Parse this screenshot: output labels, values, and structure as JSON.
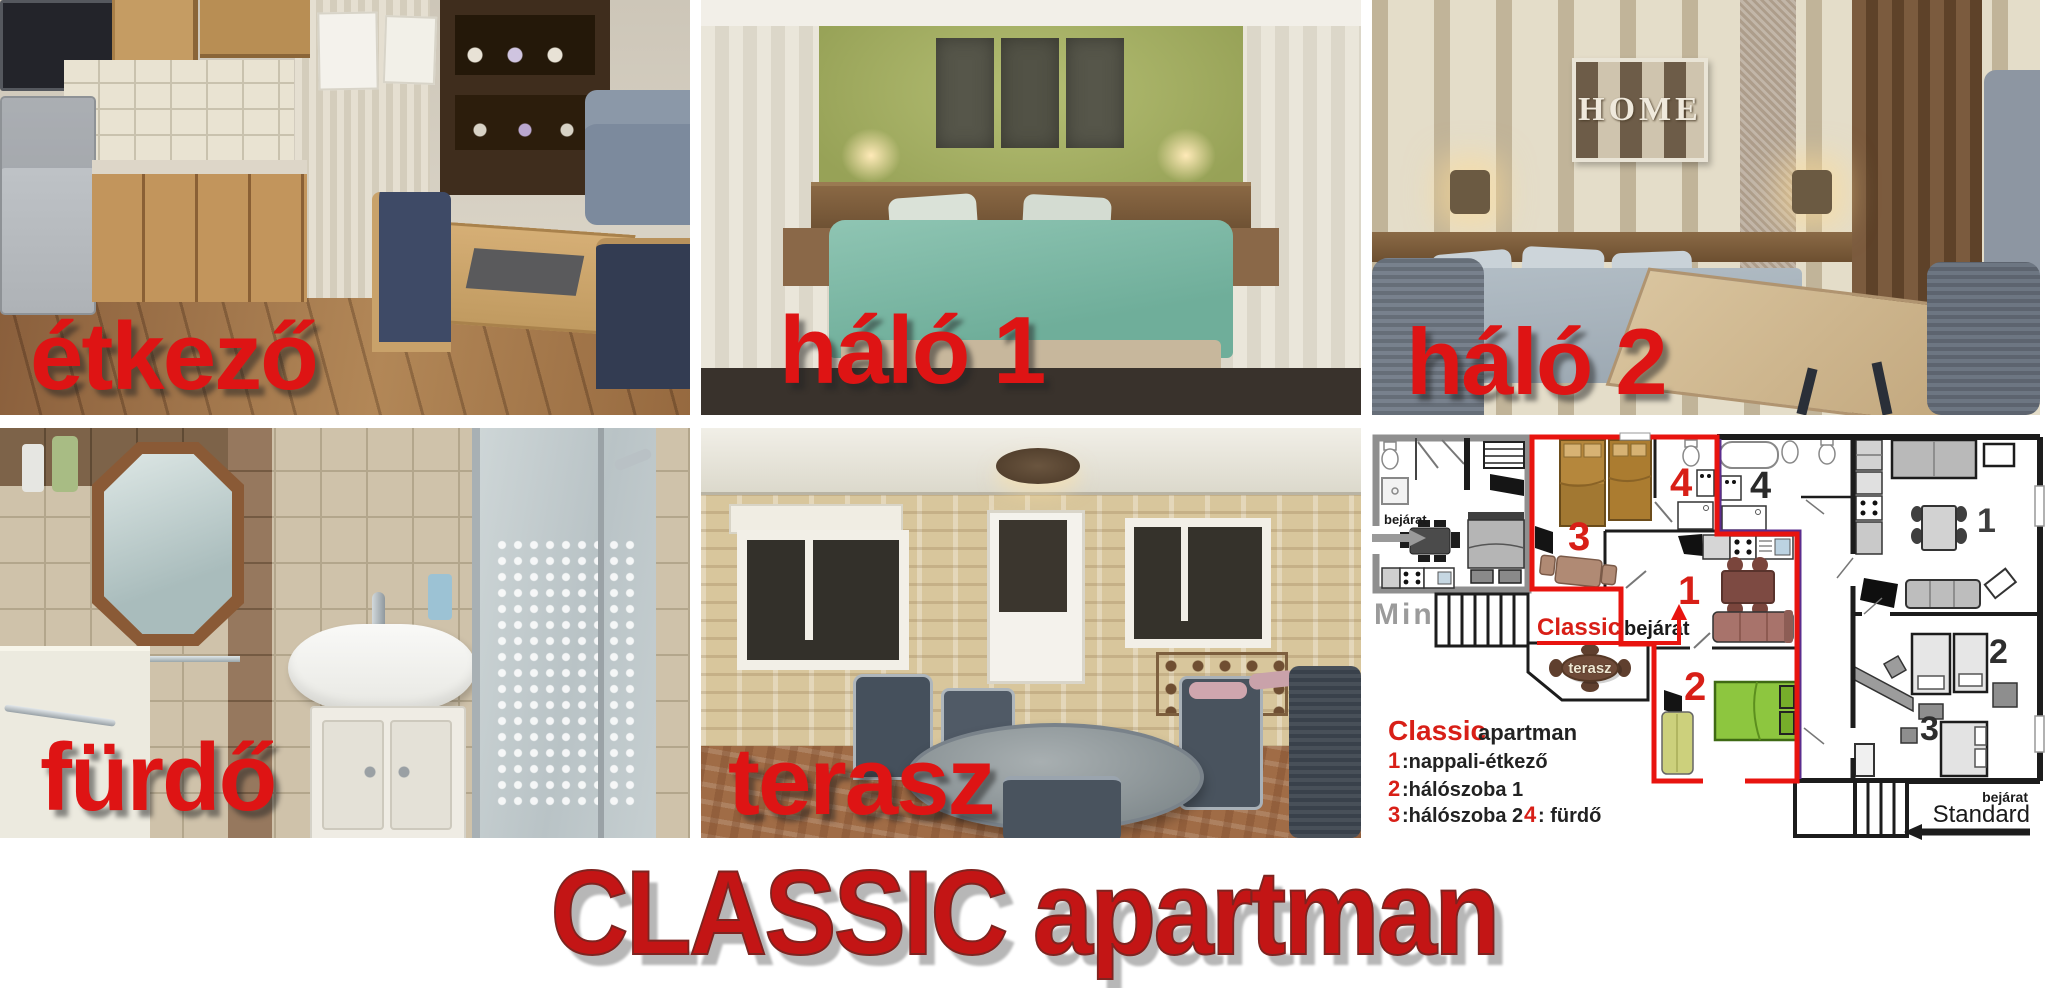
{
  "collage": {
    "title": "CLASSIC apartman",
    "photos": [
      {
        "id": "etkezo",
        "label": "étkező"
      },
      {
        "id": "halo1",
        "label": "háló 1"
      },
      {
        "id": "halo2",
        "label": "háló 2"
      },
      {
        "id": "furdo",
        "label": "fürdő"
      },
      {
        "id": "terasz",
        "label": "terasz"
      }
    ],
    "home_art_text": "HOME"
  },
  "floorplan": {
    "mini": {
      "entrance_label": "bejárat",
      "name": "Mini"
    },
    "classic": {
      "entrance_brand": "Classic",
      "entrance_word": "bejárat",
      "terrace_label": "terasz",
      "room_numbers": {
        "living": "1",
        "bed1": "2",
        "bed2": "3",
        "bath": "4"
      }
    },
    "standard": {
      "entrance_label": "bejárat",
      "name": "Standard",
      "room_numbers": {
        "living": "1",
        "bed2": "2",
        "bed3": "3",
        "bath": "4"
      }
    },
    "legend": {
      "brand": "Classic",
      "rest": "apartman",
      "items": [
        {
          "num": "1",
          "text": ":nappali-étkező"
        },
        {
          "num": "2",
          "text": ":hálószoba 1"
        },
        {
          "num": "3",
          "text": ":hálószoba 2"
        },
        {
          "num": "4",
          "text": ": fürdő"
        }
      ]
    },
    "colors": {
      "classic_outline": "#e8140f",
      "standard_divider": "#5b2d8e",
      "label_red": "#d81f17"
    }
  }
}
